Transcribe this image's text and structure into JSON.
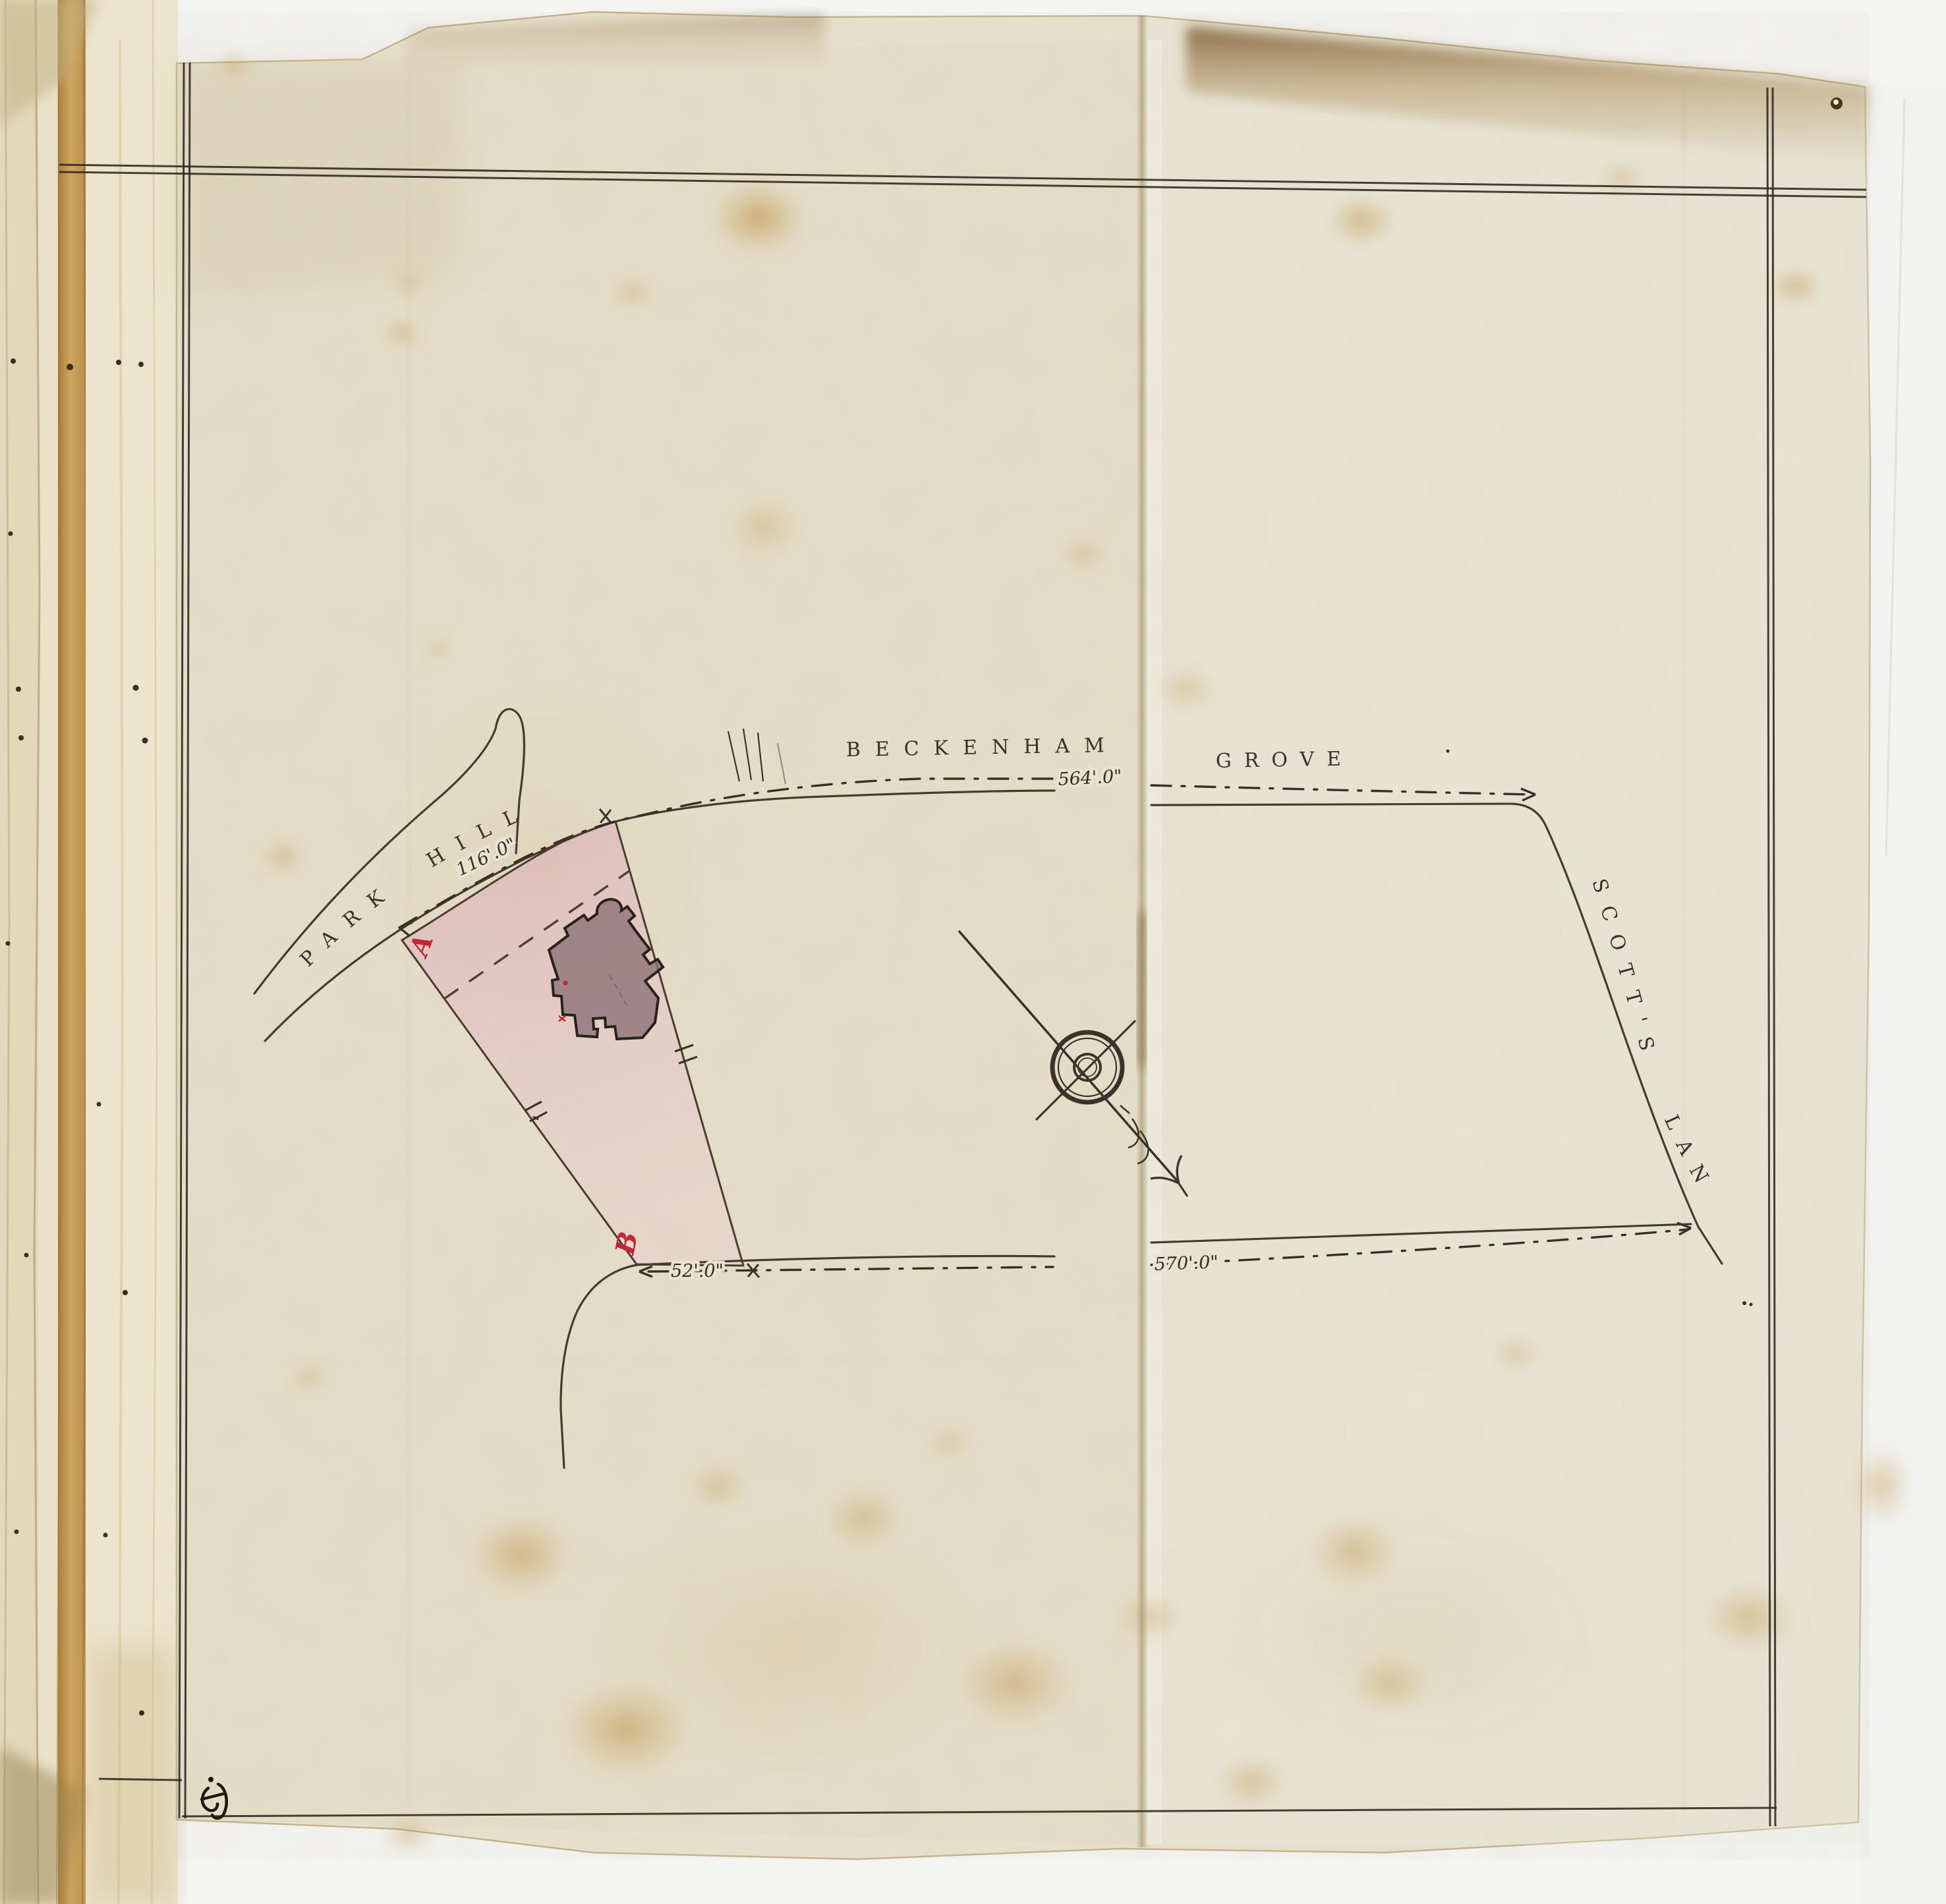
{
  "plan": {
    "kind": "hand-drawn land survey plan in bound volume",
    "roads": {
      "park_hill": "PARK HILL",
      "beckenham": "BECKENHAM",
      "grove": "GROVE",
      "scotts_lane": "SCOTT'S LANE"
    },
    "measurements": {
      "beckenham": "564'.0\"",
      "park_hill": "116'.0\"",
      "frontage": "52'.0\"",
      "south_road": "570'.0\""
    },
    "markers": {
      "a": "A",
      "b": "B"
    },
    "colors": {
      "sheet_paper": "#e8e2d0",
      "backing_paper": "#f3f3f2",
      "ink": "#3a332a",
      "frame_rule": "#2c2820",
      "plot_wash_pink": "#e3b0c0",
      "building_fill": "#8d7279",
      "marker_red": "#c12737",
      "stain_amber": "#c08a3e",
      "book_edge_amber": "#c99c58"
    }
  }
}
